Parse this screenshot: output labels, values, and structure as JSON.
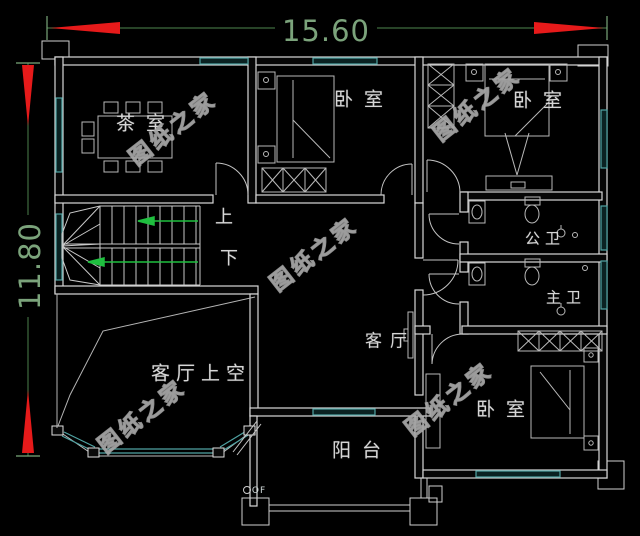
{
  "dimensions": {
    "width": "15.60",
    "height": "11.80"
  },
  "rooms": {
    "tea_room": "茶室",
    "bedroom_top": "卧室",
    "bedroom_right": "卧室",
    "bedroom_bottom": "卧室",
    "public_bath": "公卫",
    "master_bath": "主卫",
    "living_room": "客厅",
    "living_room_void": "客厅上空",
    "balcony": "阳台"
  },
  "stairs": {
    "up": "上",
    "down": "下"
  },
  "annotations": {
    "drain": "OF"
  },
  "watermark": {
    "text": "图纸之家"
  },
  "colors": {
    "background": "#000000",
    "wall": "#d8d8d8",
    "window": "#4fa3a3",
    "dimension_line": "#3f6b3f",
    "dimension_text": "#7ba37b",
    "arrow": "#e61a1a",
    "stair_arrow": "#1fbf3f",
    "label": "#d6d6d6",
    "watermark": "#9a9a9a"
  }
}
